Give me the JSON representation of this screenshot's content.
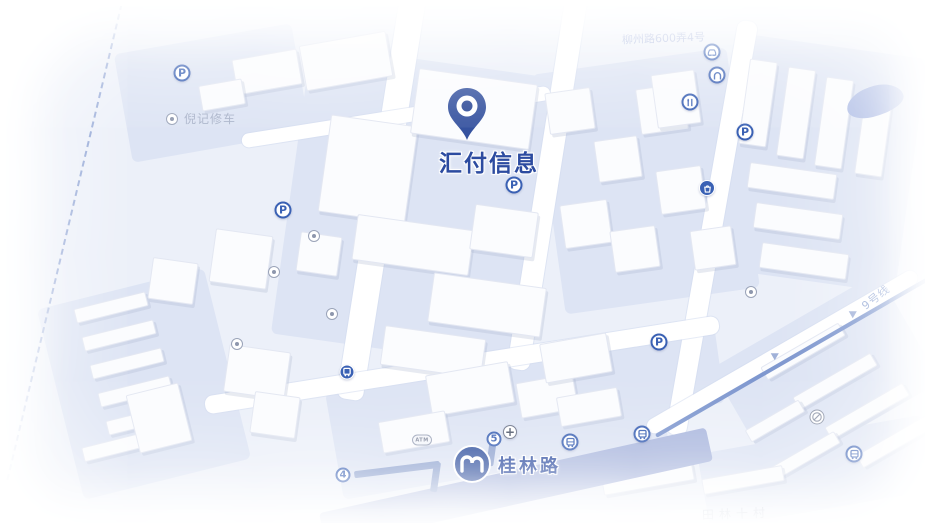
{
  "map": {
    "destination": {
      "label": "汇付信息"
    },
    "metro_station": {
      "name": "桂林路"
    },
    "colors": {
      "pin": "#35529f",
      "accent": "#2c4ba0",
      "metro": "#2f4f9e",
      "band": "#aab7de",
      "line": "#7e97cf",
      "iconblue": "#3a61b4"
    },
    "labels": [
      {
        "name": "repair-shop-label",
        "text": "倪记修车",
        "x": 182,
        "y": 111,
        "size": 12,
        "color": "#a9b3c9",
        "rot": 0,
        "ls": 1
      },
      {
        "name": "address-label",
        "text": "柳州路600弄4号",
        "x": 620,
        "y": 31,
        "size": 11,
        "color": "#9dacd8",
        "rot": -2,
        "ls": 0
      },
      {
        "name": "road-label-19",
        "text": "19号",
        "x": 433,
        "y": 497,
        "size": 11,
        "color": "#aab9e0",
        "rot": -5,
        "ls": 1
      },
      {
        "name": "district-label",
        "text": "田林十村",
        "x": 700,
        "y": 506,
        "size": 12,
        "color": "#9aa5bd",
        "rot": -2,
        "ls": 5
      },
      {
        "name": "metro-line9-label",
        "text": "9号线",
        "x": 858,
        "y": 290,
        "size": 11,
        "color": "#8fa5d4",
        "rot": -38,
        "ls": 1
      }
    ],
    "icons": [
      {
        "type": "parking",
        "name": "parking-icon",
        "x": 180,
        "y": 71
      },
      {
        "type": "parking",
        "name": "parking-icon",
        "x": 281,
        "y": 208
      },
      {
        "type": "parking",
        "name": "parking-icon",
        "x": 512,
        "y": 183
      },
      {
        "type": "parking",
        "name": "parking-icon",
        "x": 743,
        "y": 130
      },
      {
        "type": "parking",
        "name": "parking-icon",
        "x": 657,
        "y": 340
      },
      {
        "type": "car",
        "name": "car-service-icon",
        "x": 710,
        "y": 50
      },
      {
        "type": "home",
        "name": "hotel-icon",
        "x": 715,
        "y": 73
      },
      {
        "type": "food",
        "name": "restaurant-icon",
        "x": 688,
        "y": 100
      },
      {
        "type": "shopping",
        "name": "shopping-icon",
        "x": 705,
        "y": 186
      },
      {
        "type": "poi",
        "name": "poi-dot-icon",
        "x": 170,
        "y": 117
      },
      {
        "type": "poi",
        "name": "poi-dot-icon",
        "x": 312,
        "y": 234
      },
      {
        "type": "poi",
        "name": "poi-dot-icon",
        "x": 272,
        "y": 270
      },
      {
        "type": "poi",
        "name": "poi-dot-icon",
        "x": 330,
        "y": 312
      },
      {
        "type": "poi",
        "name": "poi-dot-icon",
        "x": 235,
        "y": 342
      },
      {
        "type": "poi",
        "name": "poi-dot-icon",
        "x": 749,
        "y": 290
      },
      {
        "type": "bus-stop",
        "name": "bus-stop-icon",
        "x": 345,
        "y": 370
      },
      {
        "type": "bus",
        "name": "bus-icon",
        "x": 568,
        "y": 440
      },
      {
        "type": "bus",
        "name": "bus-icon",
        "x": 640,
        "y": 432
      },
      {
        "type": "bus",
        "name": "bus-icon",
        "x": 852,
        "y": 452
      },
      {
        "type": "no-entry",
        "name": "traffic-sign-icon",
        "x": 815,
        "y": 415
      },
      {
        "type": "atm",
        "name": "atm-icon",
        "x": 420,
        "y": 438
      },
      {
        "type": "cross",
        "name": "hospital-cross-icon",
        "x": 508,
        "y": 430
      },
      {
        "type": "metro-exit",
        "name": "metro-exit-5",
        "x": 492,
        "y": 437,
        "text": "5"
      },
      {
        "type": "metro-exit",
        "name": "metro-exit-4",
        "x": 341,
        "y": 473,
        "text": "4"
      }
    ]
  }
}
